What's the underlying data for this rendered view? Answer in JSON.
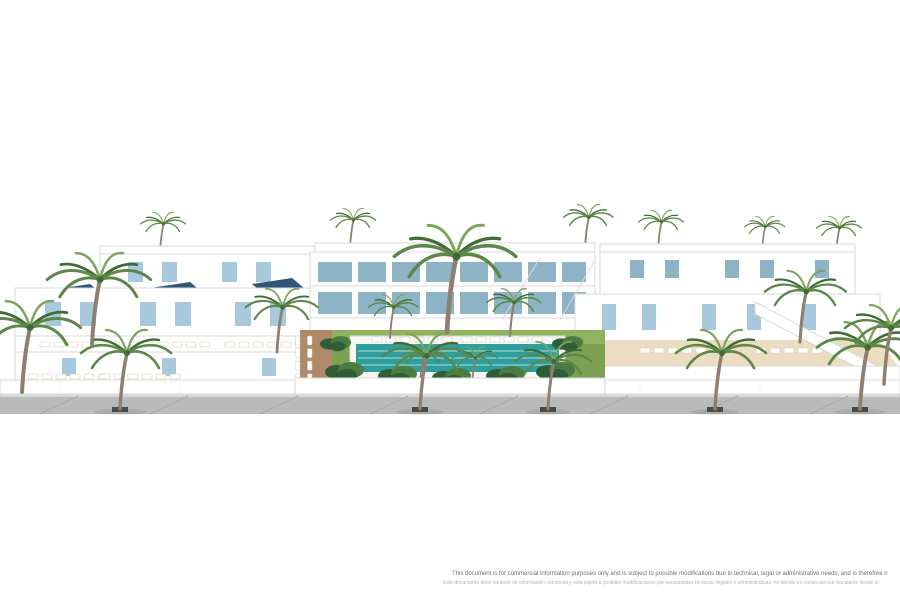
{
  "scene": {
    "alt": "Aerial 3D architectural rendering of a white Mediterranean residential complex: two-storey townhouses with light-blue shutters and rooftop solar panels around a communal garden with turquoise pool, sun loungers and palm trees, fronted by a grey palm-lined street",
    "colors": {
      "bg": "#ffffff",
      "outline": "#d9d9d9",
      "shade": "#f0f0ee",
      "street": "#b9babc",
      "curb": "#d9dadb",
      "joint": "#a9aaac",
      "pit": "#4a4a46",
      "trunk": "#8d8070",
      "frond": "#5c8748",
      "frondDark": "#3f6b35",
      "frondLight": "#7ea35c",
      "plant": "#4a7d3f",
      "plantDark": "#2f5d36",
      "lawn": "#7da152",
      "lawnLight": "#8fb35e",
      "paving": "#b08968",
      "shutter": "#a7c8dd",
      "glass": "#8fb3c6",
      "solar": "#2f5578",
      "beige": "#ecdcc2",
      "beigeLight": "#f3ead9",
      "deck": "#f7f7f4",
      "pool": "#2f9f9d",
      "poolLine": "#aadcd8",
      "loungerEdge": "#d8cdb2",
      "textPrimary": "#6f6f6f",
      "textSecondary": "#b2b2b2"
    }
  },
  "disclaimer": {
    "line1_en": "This document is for commercial information purposes only and is subject to possible modifications due to technical, legal or administrative needs, and is therefore n",
    "line2_es": "Este documento tiene carácter de información comercial y está sujeta a posibles modificaciones por necesidades técnicas, legales o administrativas, no siendo en consecuencia vinculante desde el"
  }
}
